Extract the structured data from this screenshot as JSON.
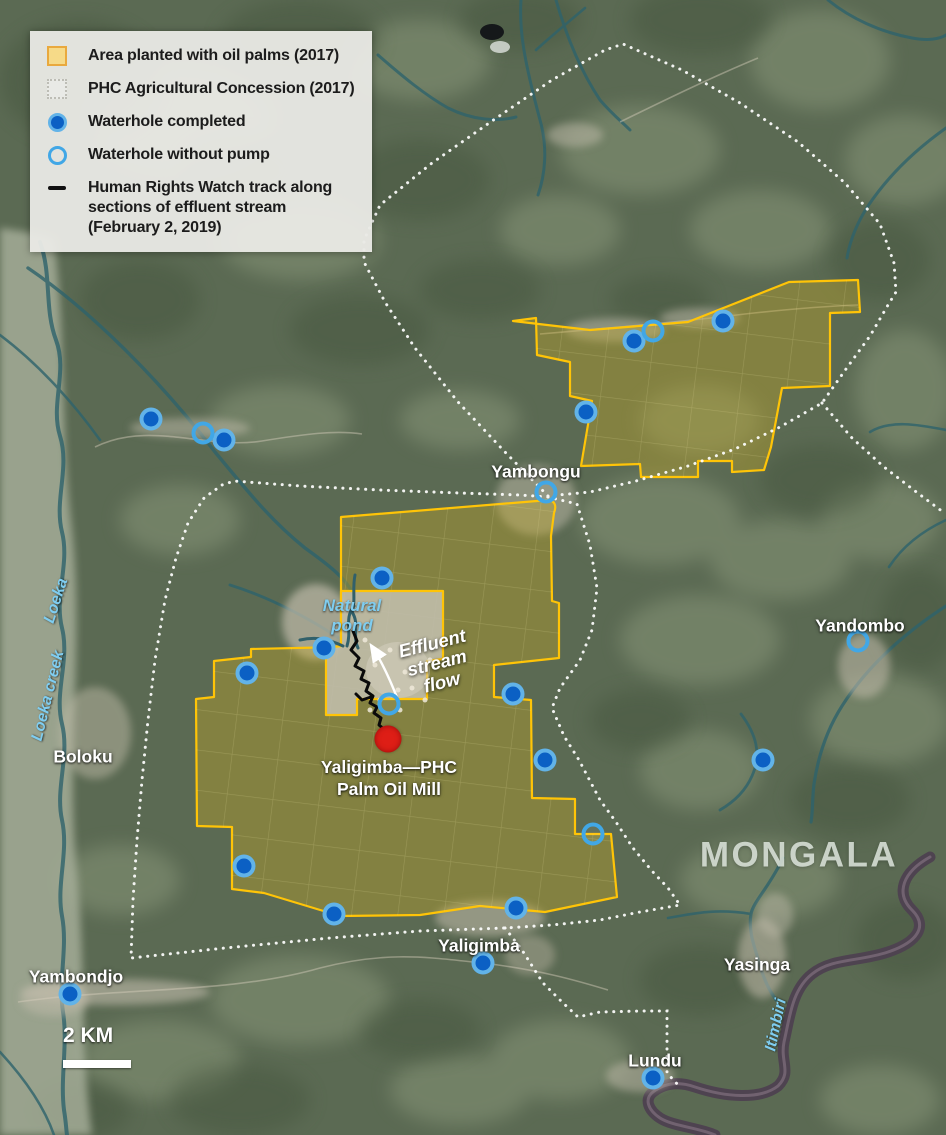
{
  "legend": {
    "items": [
      {
        "symbol": "oil-palm-area-swatch",
        "label": "Area planted with oil palms (2017)"
      },
      {
        "symbol": "concession-swatch",
        "label": "PHC Agricultural Concession (2017)"
      },
      {
        "symbol": "waterhole-completed-marker",
        "label": "Waterhole completed"
      },
      {
        "symbol": "waterhole-without-pump-marker",
        "label": "Waterhole without pump"
      },
      {
        "symbol": "hrw-track-line",
        "label": "Human Rights Watch track along\nsections of effluent stream\n(February 2, 2019)"
      }
    ]
  },
  "map": {
    "scale": {
      "label": "2 KM"
    },
    "mill": {
      "x": 388,
      "y": 739,
      "label_line1": "Yaligimba—PHC",
      "label_line2": "Palm Oil Mill"
    },
    "labels": [
      {
        "text": "Yambongu",
        "x": 536,
        "y": 472,
        "kind": "place"
      },
      {
        "text": "Yandombo",
        "x": 860,
        "y": 626,
        "kind": "place"
      },
      {
        "text": "Boloku",
        "x": 83,
        "y": 757,
        "kind": "place"
      },
      {
        "text": "Yaligimba",
        "x": 479,
        "y": 946,
        "kind": "place"
      },
      {
        "text": "Yasinga",
        "x": 757,
        "y": 965,
        "kind": "place"
      },
      {
        "text": "Yambondjo",
        "x": 76,
        "y": 977,
        "kind": "place"
      },
      {
        "text": "Lundu",
        "x": 655,
        "y": 1061,
        "kind": "place"
      },
      {
        "text": "MONGALA",
        "x": 799,
        "y": 855,
        "kind": "region"
      },
      {
        "text": "Natural\npond",
        "x": 352,
        "y": 616,
        "kind": "water pond"
      },
      {
        "text": "Loeka",
        "x": 57,
        "y": 601,
        "kind": "water",
        "rot": -72
      },
      {
        "text": "Loeka creek",
        "x": 49,
        "y": 696,
        "kind": "water",
        "rot": -76
      },
      {
        "text": "Itimbiri",
        "x": 777,
        "y": 1025,
        "kind": "water",
        "rot": -78
      },
      {
        "text": "Effluent\nstream\nflow",
        "x": 437,
        "y": 663,
        "kind": "annotation",
        "rot": -14
      }
    ],
    "waterholes": [
      {
        "x": 151,
        "y": 419,
        "type": "completed"
      },
      {
        "x": 224,
        "y": 440,
        "type": "completed"
      },
      {
        "x": 203,
        "y": 433,
        "type": "no_pump"
      },
      {
        "x": 634,
        "y": 341,
        "type": "completed"
      },
      {
        "x": 653,
        "y": 331,
        "type": "no_pump"
      },
      {
        "x": 723,
        "y": 321,
        "type": "completed"
      },
      {
        "x": 586,
        "y": 412,
        "type": "completed"
      },
      {
        "x": 546,
        "y": 492,
        "type": "no_pump"
      },
      {
        "x": 382,
        "y": 578,
        "type": "completed"
      },
      {
        "x": 324,
        "y": 648,
        "type": "completed"
      },
      {
        "x": 247,
        "y": 673,
        "type": "completed"
      },
      {
        "x": 389,
        "y": 704,
        "type": "no_pump"
      },
      {
        "x": 513,
        "y": 694,
        "type": "completed"
      },
      {
        "x": 545,
        "y": 760,
        "type": "completed"
      },
      {
        "x": 763,
        "y": 760,
        "type": "completed"
      },
      {
        "x": 858,
        "y": 641,
        "type": "no_pump"
      },
      {
        "x": 593,
        "y": 834,
        "type": "no_pump"
      },
      {
        "x": 244,
        "y": 866,
        "type": "completed"
      },
      {
        "x": 334,
        "y": 914,
        "type": "completed"
      },
      {
        "x": 516,
        "y": 908,
        "type": "completed"
      },
      {
        "x": 483,
        "y": 963,
        "type": "completed"
      },
      {
        "x": 70,
        "y": 994,
        "type": "completed"
      },
      {
        "x": 653,
        "y": 1078,
        "type": "completed"
      }
    ],
    "colors": {
      "plantation_border": "#ffc407",
      "waterhole_completed": "#0b60c4",
      "waterhole_ring": "#62b3e8",
      "waterhole_no_pump": "#41a7e6",
      "mill": "#de1e16",
      "concession_boundary": "#ffffff",
      "water_label": "#7fcdf0"
    }
  }
}
